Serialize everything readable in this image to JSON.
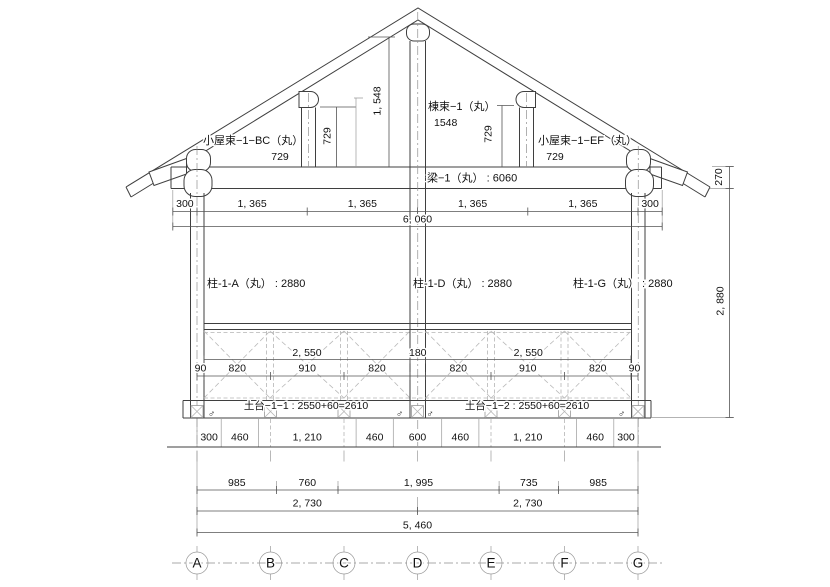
{
  "drawing": {
    "labels": {
      "strut_left": "小屋束−1−BC（丸）",
      "strut_left_len": "729",
      "ridge": "棟束−1（丸）",
      "ridge_len": "1548",
      "strut_right": "小屋束−1−EF（丸）",
      "strut_right_len": "729",
      "beam": "梁−1（丸） : 6060",
      "col_a": "柱-1-A（丸） : 2880",
      "col_d": "柱-1-D（丸） : 2880",
      "col_g": "柱-1-G（丸） : 2880",
      "sill_left": "土台−1−1 : 2550+60=2610",
      "sill_right": "土台−1−2 : 2550+60=2610",
      "male": "♂"
    },
    "dims": {
      "ridge_height": "1, 548",
      "strut_left_h": "729",
      "strut_right_h": "729",
      "eave": "270",
      "wall": "2, 880",
      "beam_row": [
        "300",
        "1, 365",
        "1, 365",
        "1, 365",
        "1, 365",
        "300"
      ],
      "beam_total": "6, 060",
      "rail_upper": [
        "2, 550",
        "180",
        "2, 550"
      ],
      "rail_lower": [
        "90",
        "820",
        "910",
        "820",
        "820",
        "910",
        "820",
        "90"
      ],
      "found_row": [
        "300",
        "460",
        "1, 210",
        "460",
        "600",
        "460",
        "1, 210",
        "460",
        "300"
      ],
      "span_row": [
        "985",
        "760",
        "1, 995",
        "735",
        "985"
      ],
      "half_span": [
        "2, 730",
        "2, 730"
      ],
      "total": "5, 460"
    },
    "grid": [
      "A",
      "B",
      "C",
      "D",
      "E",
      "F",
      "G"
    ]
  }
}
